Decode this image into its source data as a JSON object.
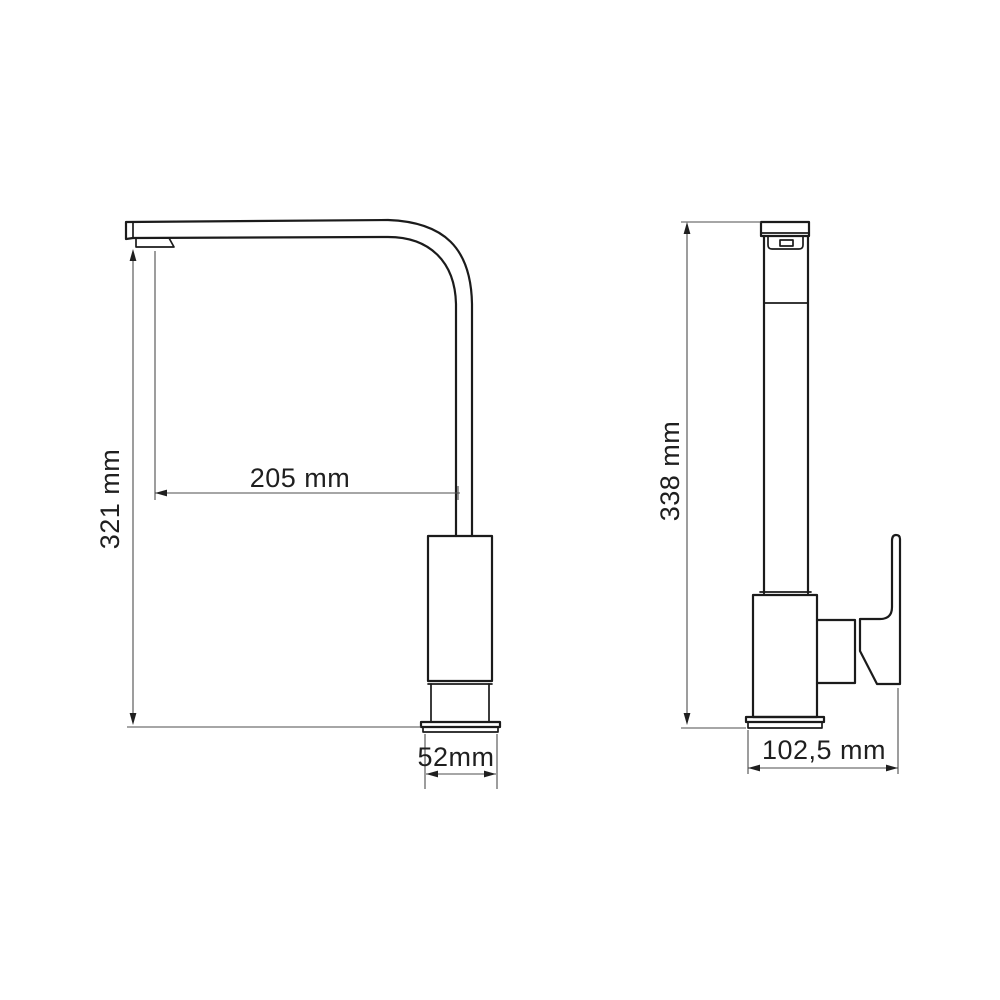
{
  "drawing": {
    "type": "faucet-technical-drawing",
    "views": 2
  },
  "dimensions": {
    "side_height": {
      "label": "321 mm",
      "value": 321,
      "unit": "mm"
    },
    "spout_reach": {
      "label": "205 mm",
      "value": 205,
      "unit": "mm"
    },
    "base_width": {
      "label": "52mm",
      "value": 52,
      "unit": "mm"
    },
    "front_height": {
      "label": "338 mm",
      "value": 338,
      "unit": "mm"
    },
    "front_width": {
      "label": "102,5 mm",
      "value": 102.5,
      "unit": "mm"
    }
  },
  "colors": {
    "background": "#ffffff",
    "outline": "#1b1b1b",
    "dimension_line": "#4d4d4d",
    "arrow": "#1f1f1f",
    "text": "#1f1f1f"
  }
}
